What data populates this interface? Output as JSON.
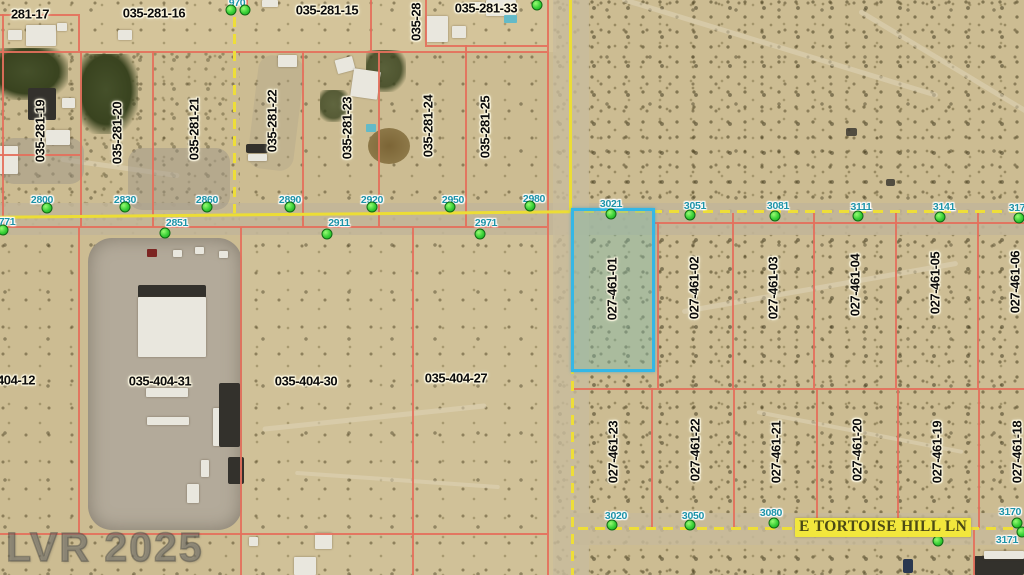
{
  "watermark": "LVR 2025",
  "street": {
    "name": "E TORTOISE HILL LN"
  },
  "colors": {
    "parcel_line": "#e4705c",
    "road_line": "#ecdd35",
    "address_text": "#1d93a8",
    "address_dot": "#33cd33",
    "highlight_border": "#34b7e6",
    "highlight_fill": "rgba(128,184,168,0.45)",
    "street_label_bg": "#f2e73c",
    "street_label_text": "#4c4a16",
    "desert_base": "#ccbc92"
  },
  "highlight_parcel": {
    "apn": "027-461-01",
    "x": 571,
    "y": 208,
    "w": 84,
    "h": 164
  },
  "parcel_labels": {
    "horizontal": [
      {
        "text": "281-17",
        "cx": 30,
        "cy": 14,
        "clipped": "left"
      },
      {
        "text": "035-281-16",
        "cx": 154,
        "cy": 13
      },
      {
        "text": "035-281-15",
        "cx": 327,
        "cy": 10
      },
      {
        "text": "035-281-33",
        "cx": 486,
        "cy": 8
      },
      {
        "text": "404-12",
        "cx": 16,
        "cy": 380,
        "clipped": "left"
      },
      {
        "text": "035-404-31",
        "cx": 160,
        "cy": 381
      },
      {
        "text": "035-404-30",
        "cx": 306,
        "cy": 381
      },
      {
        "text": "035-404-27",
        "cx": 456,
        "cy": 378
      }
    ],
    "vertical": [
      {
        "text": "035-281-19",
        "cx": 40,
        "cy": 131
      },
      {
        "text": "035-281-20",
        "cx": 117,
        "cy": 133
      },
      {
        "text": "035-281-21",
        "cx": 194,
        "cy": 129
      },
      {
        "text": "035-281-22",
        "cx": 272,
        "cy": 121
      },
      {
        "text": "035-281-23",
        "cx": 347,
        "cy": 128
      },
      {
        "text": "035-281-24",
        "cx": 428,
        "cy": 126
      },
      {
        "text": "035-281-25",
        "cx": 485,
        "cy": 127
      },
      {
        "text": "035-28",
        "cx": 416,
        "cy": 22,
        "clipped": "top"
      },
      {
        "text": "027-461-01",
        "cx": 612,
        "cy": 289,
        "highlighted": true
      },
      {
        "text": "027-461-02",
        "cx": 694,
        "cy": 288
      },
      {
        "text": "027-461-03",
        "cx": 773,
        "cy": 288
      },
      {
        "text": "027-461-04",
        "cx": 855,
        "cy": 285
      },
      {
        "text": "027-461-05",
        "cx": 935,
        "cy": 283
      },
      {
        "text": "027-461-06",
        "cx": 1015,
        "cy": 282,
        "clipped": "right"
      },
      {
        "text": "027-461-23",
        "cx": 613,
        "cy": 452
      },
      {
        "text": "027-461-22",
        "cx": 695,
        "cy": 450
      },
      {
        "text": "027-461-21",
        "cx": 776,
        "cy": 452
      },
      {
        "text": "027-461-20",
        "cx": 857,
        "cy": 450
      },
      {
        "text": "027-461-19",
        "cx": 937,
        "cy": 452
      },
      {
        "text": "027-461-18",
        "cx": 1017,
        "cy": 452,
        "clipped": "right"
      }
    ]
  },
  "addresses": [
    {
      "text": "970",
      "cx": 237,
      "cy": 3,
      "dot": [
        231,
        10
      ],
      "clipped": "top"
    },
    {
      "text": "2800",
      "cx": 42,
      "cy": 200,
      "dot": [
        47,
        208
      ]
    },
    {
      "text": "2830",
      "cx": 125,
      "cy": 200,
      "dot": [
        125,
        207
      ]
    },
    {
      "text": "2860",
      "cx": 207,
      "cy": 200,
      "dot": [
        207,
        207
      ]
    },
    {
      "text": "2890",
      "cx": 290,
      "cy": 200,
      "dot": [
        290,
        207
      ]
    },
    {
      "text": "2920",
      "cx": 372,
      "cy": 200,
      "dot": [
        372,
        207
      ]
    },
    {
      "text": "2950",
      "cx": 453,
      "cy": 200,
      "dot": [
        450,
        207
      ]
    },
    {
      "text": "2980",
      "cx": 534,
      "cy": 199,
      "dot": [
        530,
        206
      ]
    },
    {
      "text": "771",
      "cx": 7,
      "cy": 222,
      "dot": [
        3,
        230
      ],
      "clipped": "left"
    },
    {
      "text": "2851",
      "cx": 177,
      "cy": 223,
      "dot": [
        165,
        233
      ]
    },
    {
      "text": "2911",
      "cx": 339,
      "cy": 223,
      "dot": [
        327,
        234
      ]
    },
    {
      "text": "2971",
      "cx": 486,
      "cy": 223,
      "dot": [
        480,
        234
      ]
    },
    {
      "text": "3021",
      "cx": 611,
      "cy": 204,
      "dot": [
        611,
        214
      ]
    },
    {
      "text": "3051",
      "cx": 695,
      "cy": 206,
      "dot": [
        690,
        215
      ]
    },
    {
      "text": "3081",
      "cx": 778,
      "cy": 206,
      "dot": [
        775,
        216
      ]
    },
    {
      "text": "3111",
      "cx": 861,
      "cy": 207,
      "dot": [
        858,
        216
      ]
    },
    {
      "text": "3141",
      "cx": 944,
      "cy": 207,
      "dot": [
        940,
        217
      ]
    },
    {
      "text": "317",
      "cx": 1017,
      "cy": 208,
      "dot": [
        1019,
        218
      ],
      "clipped": "right"
    },
    {
      "text": "3020",
      "cx": 616,
      "cy": 516,
      "dot": [
        612,
        525
      ]
    },
    {
      "text": "3050",
      "cx": 693,
      "cy": 516,
      "dot": [
        690,
        525
      ]
    },
    {
      "text": "3080",
      "cx": 771,
      "cy": 513,
      "dot": [
        774,
        523
      ]
    },
    {
      "text": "3170",
      "cx": 1010,
      "cy": 512,
      "dot": [
        1017,
        523
      ]
    },
    {
      "text": "3171",
      "cx": 1007,
      "cy": 540,
      "dot": [
        1022,
        532
      ]
    }
  ],
  "extra_dots": [
    [
      245,
      10
    ],
    [
      537,
      5
    ],
    [
      853,
      526
    ],
    [
      935,
      529
    ],
    [
      938,
      541
    ]
  ]
}
